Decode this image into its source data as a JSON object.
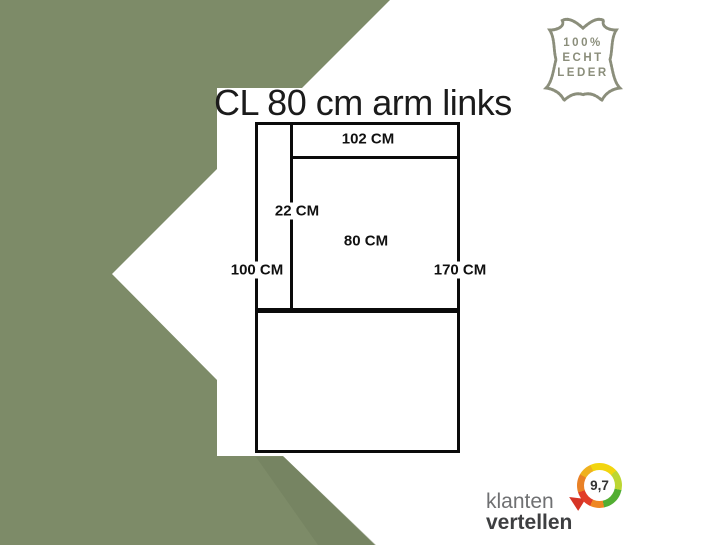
{
  "canvas": {
    "width": 726,
    "height": 545
  },
  "colors": {
    "background_green": "#7D8B68",
    "shadow_green": "#6F7D5B",
    "panel_white": "#FFFFFF",
    "diagram_line": "#0B0B0B",
    "badge_olive": "#8B8E7B",
    "title_text": "#1B1B1B",
    "brand_gray": "#6F7072",
    "brand_dark": "#3E3F41",
    "ring_yellow": "#F2D50F",
    "ring_lime": "#BCD632",
    "ring_green": "#52AE32",
    "ring_orange": "#EE8722",
    "ring_red": "#E23D28"
  },
  "title": "CL 80 cm arm links",
  "leather_badge": {
    "line1": "100%",
    "line2": "ECHT",
    "line3": "LEDER"
  },
  "diagram": {
    "back_width": "102 CM",
    "arm_width": "22 CM",
    "seat_width": "80 CM",
    "height_left": "100 CM",
    "depth_right": "170 CM"
  },
  "review_widget": {
    "brand_line1": "klanten",
    "brand_line2": "vertellen",
    "score": "9,7"
  }
}
